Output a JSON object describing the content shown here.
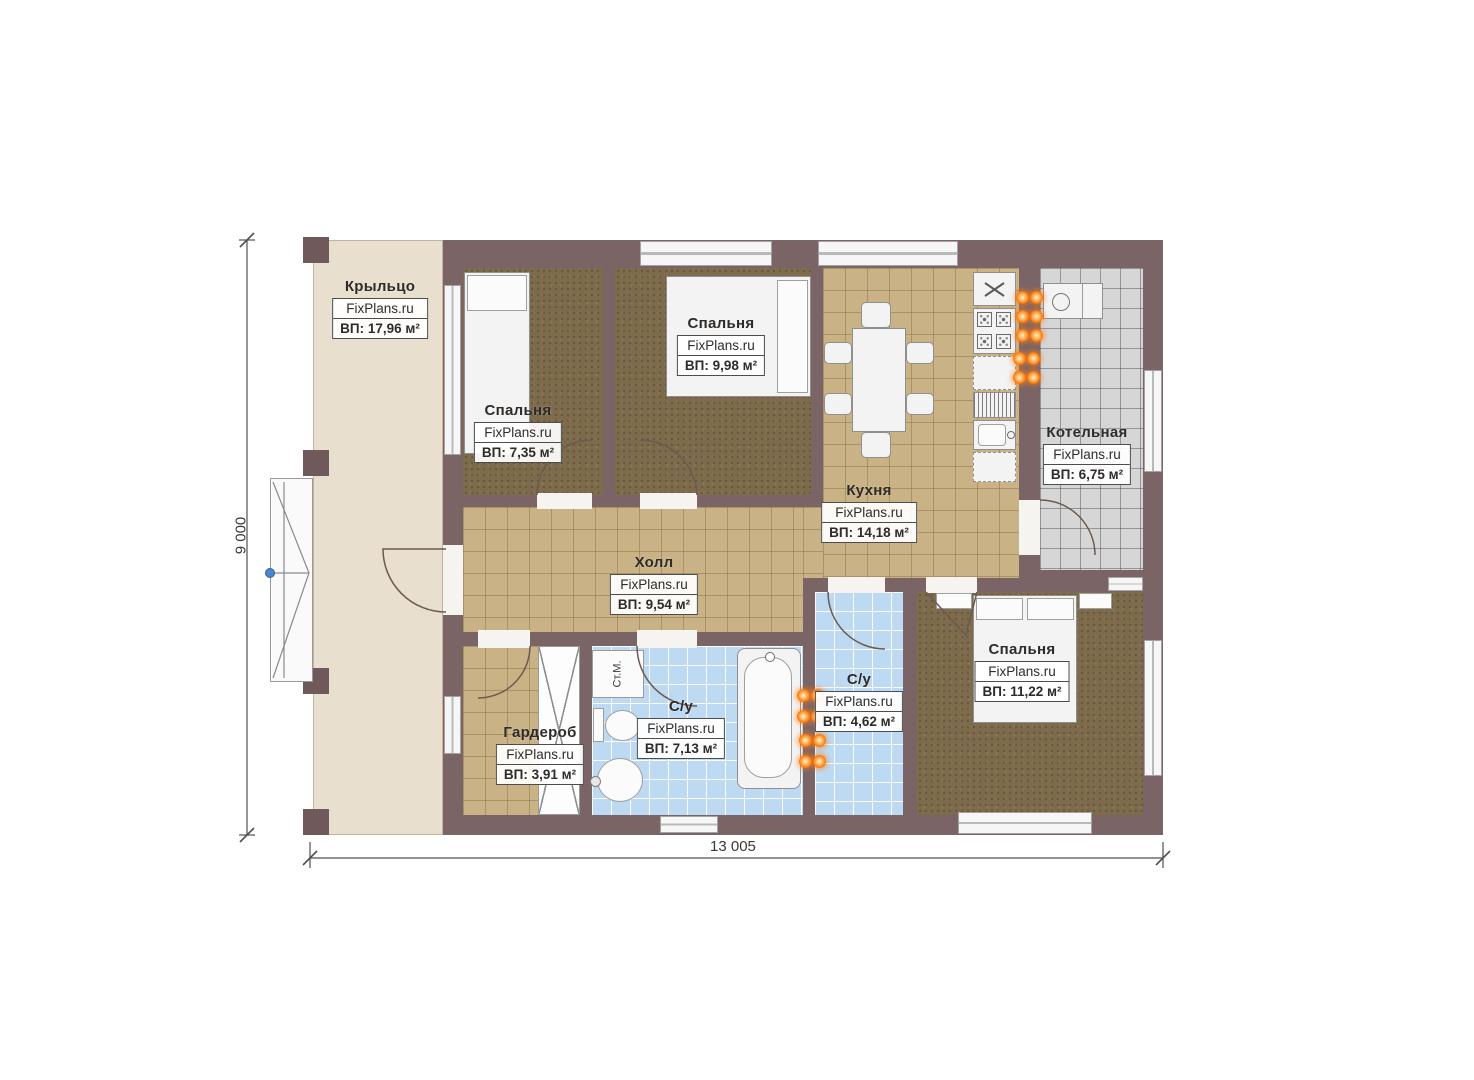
{
  "plan": {
    "brand": "FixPlans.ru",
    "rooms": [
      {
        "id": "porch",
        "name": "Крыльцо",
        "brand": "FixPlans.ru",
        "area": "ВП: 17,96 м²"
      },
      {
        "id": "bedroom-1",
        "name": "Спальня",
        "brand": "FixPlans.ru",
        "area": "ВП: 7,35 м²"
      },
      {
        "id": "bedroom-2",
        "name": "Спальня",
        "brand": "FixPlans.ru",
        "area": "ВП: 9,98 м²"
      },
      {
        "id": "kitchen",
        "name": "Кухня",
        "brand": "FixPlans.ru",
        "area": "ВП: 14,18 м²"
      },
      {
        "id": "boiler",
        "name": "Котельная",
        "brand": "FixPlans.ru",
        "area": "ВП: 6,75 м²"
      },
      {
        "id": "hall",
        "name": "Холл",
        "brand": "FixPlans.ru",
        "area": "ВП: 9,54 м²"
      },
      {
        "id": "wardrobe",
        "name": "Гардероб",
        "brand": "FixPlans.ru",
        "area": "ВП: 3,91 м²"
      },
      {
        "id": "bath-1",
        "name": "С/у",
        "brand": "FixPlans.ru",
        "area": "ВП: 7,13 м²"
      },
      {
        "id": "bath-2",
        "name": "С/у",
        "brand": "FixPlans.ru",
        "area": "ВП: 4,62 м²"
      },
      {
        "id": "bedroom-3",
        "name": "Спальня",
        "brand": "FixPlans.ru",
        "area": "ВП: 11,22 м²"
      }
    ],
    "dimensions": {
      "horizontal": "13 005",
      "vertical": "9 000"
    },
    "labels": {
      "washing_machine": "Ст.М."
    },
    "colors": {
      "wall": "#7b6466",
      "porch": "#e9dfce",
      "carpet": "#7d6b4c",
      "tile_tan": "#c9b286",
      "tile_blue": "#bedaf3",
      "tile_gray": "#d6d6d6",
      "glow_orange": "#ff7207",
      "marker_blue": "#4a86cc"
    }
  }
}
